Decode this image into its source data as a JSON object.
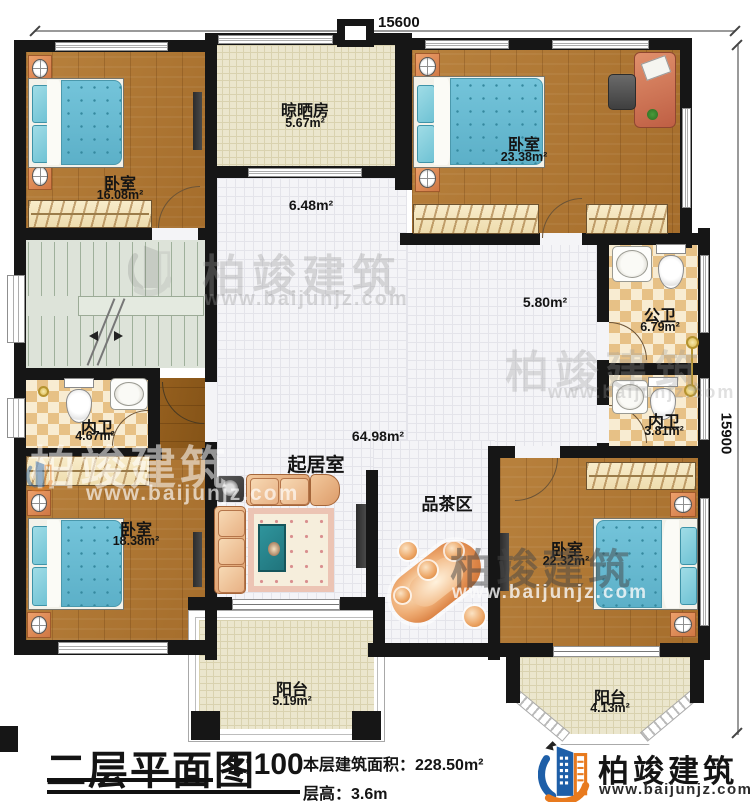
{
  "plan": {
    "dimensions": {
      "width_mm": "15600",
      "height_mm": "15900"
    },
    "rooms": {
      "bedroom_tl": {
        "name": "卧室",
        "area": "16.08m²"
      },
      "drying_room": {
        "name": "晾晒房",
        "area": "5.67m²"
      },
      "bedroom_tr": {
        "name": "卧室",
        "area": "23.38m²"
      },
      "hall": {
        "area": "6.48m²"
      },
      "corridor": {
        "area": "5.80m²"
      },
      "public_bath": {
        "name": "公卫",
        "area": "6.79m²"
      },
      "inner_bath_right": {
        "name": "内卫",
        "area": "3.81m²"
      },
      "inner_bath_left": {
        "name": "内卫",
        "area": "4.67m²"
      },
      "bedroom_bl": {
        "name": "卧室",
        "area": "18.38m²"
      },
      "living_room": {
        "name": "起居室",
        "area": "64.98m²"
      },
      "tea_area": {
        "name": "品茶区"
      },
      "bedroom_br": {
        "name": "卧室",
        "area": "22.32m²"
      },
      "balcony_center": {
        "name": "阳台",
        "area": "5.19m²"
      },
      "balcony_right": {
        "name": "阳台",
        "area": "4.13m²"
      }
    }
  },
  "title_block": {
    "title": "二层平面图",
    "scale": "1:100",
    "floor_area": "本层建筑面积：228.50m²",
    "floor_height": "层高：3.6m"
  },
  "brand": {
    "name": "柏竣建筑",
    "url": "www.baijunjz.com"
  },
  "colors": {
    "wall": "#161616",
    "wood_floor": "#b07a38",
    "beige_tile": "#ebe6cd",
    "white_tile": "#f4f4f7",
    "bath_tile": "#e7c186",
    "bed_blue": "#66b9d3",
    "brand_blue": "#1e5fa8",
    "brand_orange": "#e87a1e"
  }
}
